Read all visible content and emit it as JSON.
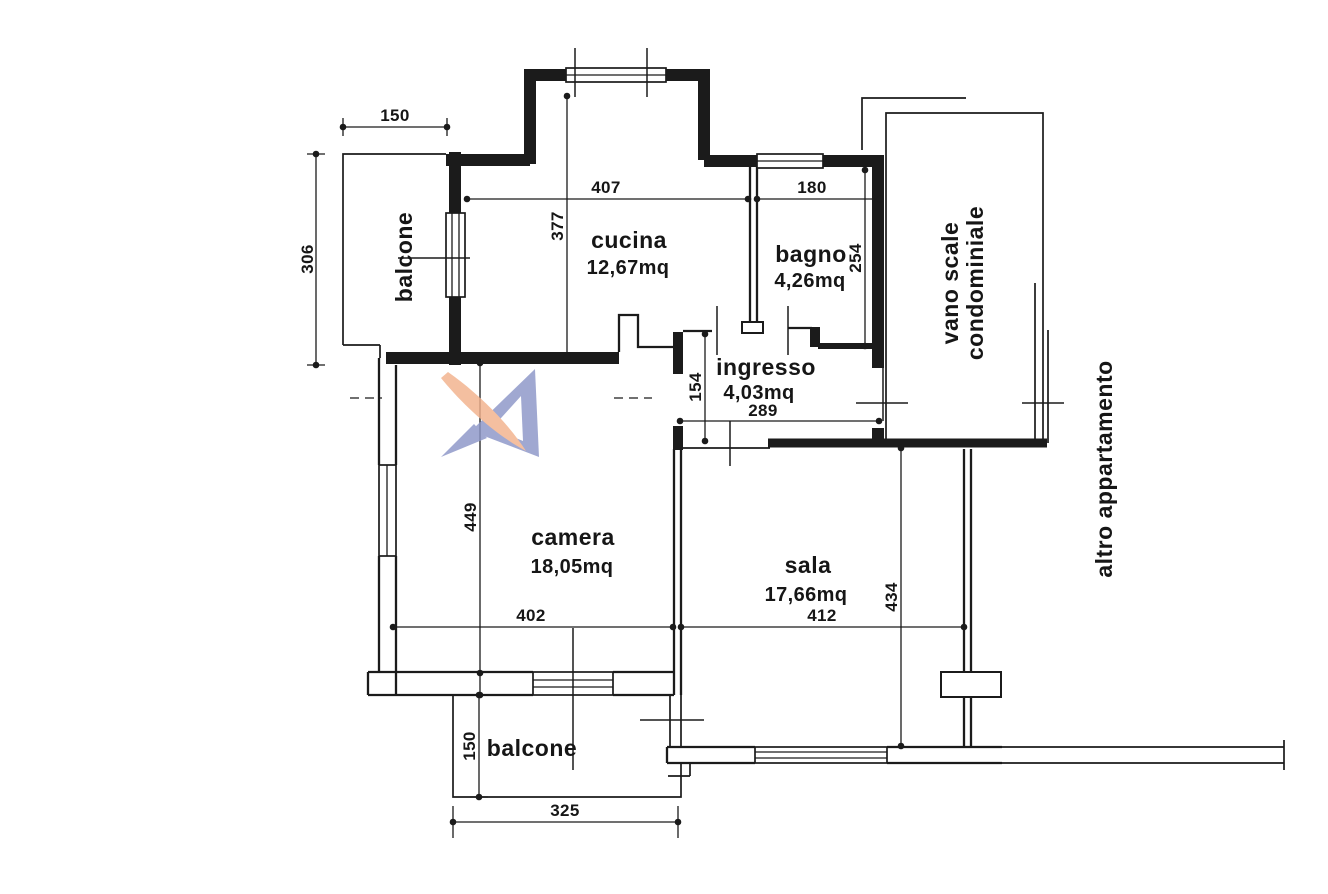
{
  "canvas": {
    "background": "#ffffff",
    "line_color": "#1b1b1b"
  },
  "watermark": {
    "orange": "#f2b28c",
    "blue": "#8c96c8"
  },
  "rooms": {
    "balcone_top": {
      "label": "balcone"
    },
    "cucina": {
      "label": "cucina",
      "area": "12,67mq"
    },
    "bagno": {
      "label": "bagno",
      "area": "4,26mq"
    },
    "vano_scale": {
      "line1": "vano scale",
      "line2": "condominiale"
    },
    "ingresso": {
      "label": "ingresso",
      "area": "4,03mq"
    },
    "camera": {
      "label": "camera",
      "area": "18,05mq"
    },
    "sala": {
      "label": "sala",
      "area": "17,66mq"
    },
    "balcone_bottom": {
      "label": "balcone"
    },
    "altro_appartamento": {
      "label": "altro appartamento"
    }
  },
  "dims": {
    "balcone_top_width": "150",
    "balcone_top_height": "306",
    "cucina_width": "407",
    "cucina_height": "377",
    "bagno_width": "180",
    "bagno_height": "254",
    "ingresso_height": "154",
    "ingresso_width": "289",
    "camera_height": "449",
    "camera_width": "402",
    "sala_width": "412",
    "sala_height": "434",
    "balcone_bottom_height": "150",
    "balcone_bottom_width": "325"
  }
}
